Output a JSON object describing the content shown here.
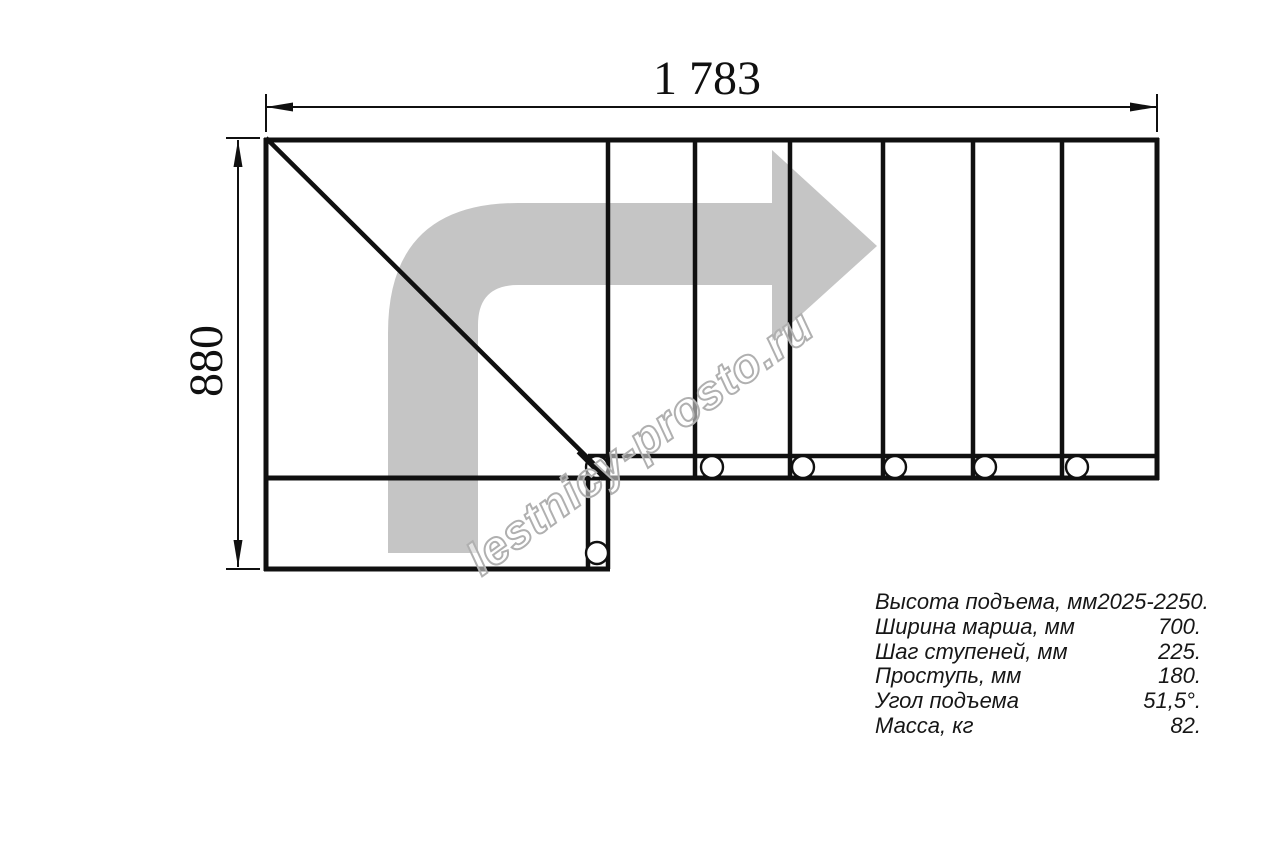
{
  "drawing": {
    "title": "stair-plan-top-view",
    "top_dimension_label": "1 783",
    "left_dimension_label": "880",
    "watermark": "lestnicy-prosto.ru",
    "icons": {
      "direction_arrow": "turn-right-direction-arrow",
      "bolt_markers": "bolt-circle"
    },
    "colors": {
      "line": "#101010",
      "arrow_fill": "#c5c5c5",
      "watermark_outline": "#b0b0b0",
      "background": "#ffffff"
    },
    "steps_count": 6
  },
  "specs": {
    "rows": [
      {
        "label": "Высота подъема, мм",
        "value": "2025-2250."
      },
      {
        "label": "Ширина марша, мм",
        "value": "700."
      },
      {
        "label": "Шаг ступеней, мм",
        "value": "225."
      },
      {
        "label": "Проступь, мм",
        "value": "180."
      },
      {
        "label": "Угол подъема",
        "value": "51,5°."
      },
      {
        "label": "Масса, кг",
        "value": "82."
      }
    ]
  }
}
